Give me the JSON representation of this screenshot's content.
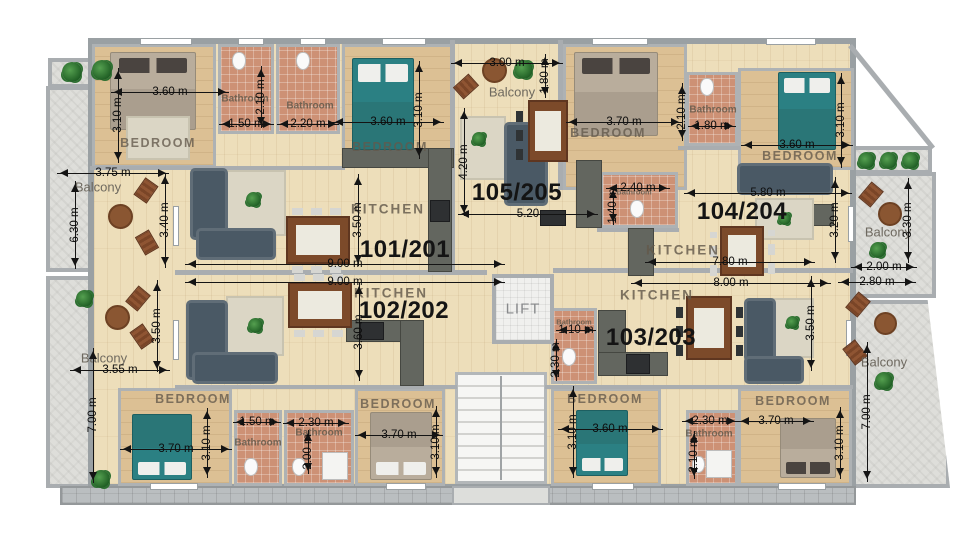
{
  "title": "Apartment building floor plan",
  "colors": {
    "wood_floor": "#eddeba",
    "bedroom_floor": "#dcc094",
    "bathroom_tile": "#cd9175",
    "balcony_stone": "#dededa",
    "wall": "#a9adb0",
    "bed_teal": "#2b8083",
    "sofa": "#4a5965",
    "table_wood": "#7c4a2a",
    "dimension_text": "#0d0d0d"
  },
  "units": [
    {
      "id": "101/201",
      "x": 405,
      "y": 250
    },
    {
      "id": "102/202",
      "x": 404,
      "y": 311
    },
    {
      "id": "105/205",
      "x": 517,
      "y": 193
    },
    {
      "id": "104/204",
      "x": 742,
      "y": 212
    },
    {
      "id": "103/203",
      "x": 651,
      "y": 338
    }
  ],
  "room_labels": [
    {
      "t": "BEDROOM",
      "cls": "bed",
      "x": 158,
      "y": 143
    },
    {
      "t": "BEDROOM",
      "cls": "bed",
      "x": 390,
      "y": 147
    },
    {
      "t": "BEDROOM",
      "cls": "bed",
      "x": 608,
      "y": 133
    },
    {
      "t": "BEDROOM",
      "cls": "bed",
      "x": 800,
      "y": 156
    },
    {
      "t": "BEDROOM",
      "cls": "bed",
      "x": 193,
      "y": 399
    },
    {
      "t": "BEDROOM",
      "cls": "bed",
      "x": 398,
      "y": 404
    },
    {
      "t": "BEDROOM",
      "cls": "bed",
      "x": 605,
      "y": 399
    },
    {
      "t": "BEDROOM",
      "cls": "bed",
      "x": 793,
      "y": 401
    },
    {
      "t": "Bathroom",
      "cls": "bath",
      "x": 245,
      "y": 99
    },
    {
      "t": "Bathroom",
      "cls": "bath",
      "x": 310,
      "y": 106
    },
    {
      "t": "Bathroom",
      "cls": "bath",
      "x": 713,
      "y": 110
    },
    {
      "t": "Bathroom",
      "cls": "bath xs",
      "x": 634,
      "y": 192
    },
    {
      "t": "Bathroom",
      "cls": "bath xs",
      "x": 574,
      "y": 322
    },
    {
      "t": "Bathroom",
      "cls": "bath",
      "x": 258,
      "y": 443
    },
    {
      "t": "Bathroom",
      "cls": "bath",
      "x": 319,
      "y": 433
    },
    {
      "t": "Bathroom",
      "cls": "bath",
      "x": 709,
      "y": 434
    },
    {
      "t": "KITCHEN",
      "cls": "kitchen",
      "x": 388,
      "y": 209
    },
    {
      "t": "KITCHEN",
      "cls": "kitchen",
      "x": 391,
      "y": 293
    },
    {
      "t": "KITCHEN",
      "cls": "kitchen",
      "x": 683,
      "y": 250
    },
    {
      "t": "KITCHEN",
      "cls": "kitchen",
      "x": 657,
      "y": 295
    },
    {
      "t": "Balcony",
      "cls": "balcony",
      "x": 98,
      "y": 187
    },
    {
      "t": "Balcony",
      "cls": "balcony",
      "x": 104,
      "y": 358
    },
    {
      "t": "Balcony",
      "cls": "balcony",
      "x": 512,
      "y": 92
    },
    {
      "t": "Balcony",
      "cls": "balcony",
      "x": 888,
      "y": 232
    },
    {
      "t": "Balcony",
      "cls": "balcony",
      "x": 884,
      "y": 362
    },
    {
      "t": "LIFT",
      "cls": "lift",
      "x": 523,
      "y": 309
    }
  ],
  "dims": [
    {
      "t": "3.60 m",
      "o": "h",
      "cx": 170,
      "cy": 92,
      "len": 118
    },
    {
      "t": "3.10 m",
      "o": "v",
      "cx": 118,
      "cy": 115,
      "len": 95
    },
    {
      "t": "1.50 m",
      "o": "h",
      "cx": 246,
      "cy": 124,
      "len": 55
    },
    {
      "t": "2.20 m",
      "o": "h",
      "cx": 308,
      "cy": 124,
      "len": 62
    },
    {
      "t": "2.10 m",
      "o": "v",
      "cx": 261,
      "cy": 97,
      "len": 62
    },
    {
      "t": "3.75 m",
      "o": "h",
      "cx": 113,
      "cy": 173,
      "len": 112
    },
    {
      "t": "6.30 m",
      "o": "v",
      "cx": 75,
      "cy": 225,
      "len": 88
    },
    {
      "t": "3.40 m",
      "o": "v",
      "cx": 165,
      "cy": 220,
      "len": 95
    },
    {
      "t": "9.00 m",
      "o": "h",
      "cx": 345,
      "cy": 264,
      "len": 320
    },
    {
      "t": "3.50 m",
      "o": "v",
      "cx": 358,
      "cy": 220,
      "len": 92
    },
    {
      "t": "3.00 m",
      "o": "h",
      "cx": 507,
      "cy": 63,
      "len": 112
    },
    {
      "t": "1.80 m",
      "o": "v",
      "cx": 545,
      "cy": 76,
      "len": 44
    },
    {
      "t": "3.60 m",
      "o": "h",
      "cx": 388,
      "cy": 122,
      "len": 112
    },
    {
      "t": "3.10 m",
      "o": "v",
      "cx": 419,
      "cy": 110,
      "len": 98
    },
    {
      "t": "4.20 m",
      "o": "v",
      "cx": 464,
      "cy": 162,
      "len": 108
    },
    {
      "t": "5.20",
      "o": "h",
      "cx": 528,
      "cy": 214,
      "len": 140
    },
    {
      "t": "2.40 m",
      "o": "h",
      "cx": 638,
      "cy": 188,
      "len": 64
    },
    {
      "t": "1.40 m",
      "o": "v",
      "cx": 613,
      "cy": 206,
      "len": 38
    },
    {
      "t": "3.70 m",
      "o": "h",
      "cx": 624,
      "cy": 122,
      "len": 116
    },
    {
      "t": "2.10 m",
      "o": "v",
      "cx": 682,
      "cy": 112,
      "len": 58
    },
    {
      "t": "1.80 m",
      "o": "h",
      "cx": 712,
      "cy": 126,
      "len": 48
    },
    {
      "t": "3.60 m",
      "o": "h",
      "cx": 797,
      "cy": 145,
      "len": 112
    },
    {
      "t": "3.10 m",
      "o": "v",
      "cx": 841,
      "cy": 120,
      "len": 95
    },
    {
      "t": "5.80 m",
      "o": "h",
      "cx": 768,
      "cy": 193,
      "len": 168
    },
    {
      "t": "3.20 m",
      "o": "v",
      "cx": 835,
      "cy": 220,
      "len": 86
    },
    {
      "t": "7.80 m",
      "o": "h",
      "cx": 730,
      "cy": 262,
      "len": 170
    },
    {
      "t": "3.30 m",
      "o": "v",
      "cx": 908,
      "cy": 220,
      "len": 85
    },
    {
      "t": "2.00 m",
      "o": "h",
      "cx": 884,
      "cy": 267,
      "len": 66
    },
    {
      "t": "9.00 m",
      "o": "h",
      "cx": 345,
      "cy": 282,
      "len": 320
    },
    {
      "t": "3.60 m",
      "o": "v",
      "cx": 359,
      "cy": 332,
      "len": 98
    },
    {
      "t": "3.50 m",
      "o": "v",
      "cx": 157,
      "cy": 326,
      "len": 92
    },
    {
      "t": "3.55 m",
      "o": "h",
      "cx": 120,
      "cy": 370,
      "len": 100
    },
    {
      "t": "7.00 m",
      "o": "v",
      "cx": 93,
      "cy": 415,
      "len": 135
    },
    {
      "t": "3.70 m",
      "o": "h",
      "cx": 176,
      "cy": 449,
      "len": 112
    },
    {
      "t": "3.10 m",
      "o": "v",
      "cx": 207,
      "cy": 443,
      "len": 70
    },
    {
      "t": "1.50 m",
      "o": "h",
      "cx": 257,
      "cy": 422,
      "len": 48
    },
    {
      "t": "2.30 m",
      "o": "h",
      "cx": 316,
      "cy": 423,
      "len": 66
    },
    {
      "t": "2.00 m",
      "o": "v",
      "cx": 308,
      "cy": 452,
      "len": 44
    },
    {
      "t": "3.70 m",
      "o": "h",
      "cx": 399,
      "cy": 435,
      "len": 88
    },
    {
      "t": "3.10 m",
      "o": "v",
      "cx": 436,
      "cy": 442,
      "len": 72
    },
    {
      "t": "8.00 m",
      "o": "h",
      "cx": 731,
      "cy": 283,
      "len": 200
    },
    {
      "t": "1.10 m",
      "o": "h",
      "cx": 576,
      "cy": 330,
      "len": 40
    },
    {
      "t": "2.30 m",
      "o": "v",
      "cx": 556,
      "cy": 360,
      "len": 42
    },
    {
      "t": "3.50 m",
      "o": "v",
      "cx": 811,
      "cy": 323,
      "len": 95
    },
    {
      "t": "2.80 m",
      "o": "h",
      "cx": 877,
      "cy": 282,
      "len": 78
    },
    {
      "t": "7.00 m",
      "o": "v",
      "cx": 867,
      "cy": 412,
      "len": 140
    },
    {
      "t": "3.60 m",
      "o": "h",
      "cx": 610,
      "cy": 429,
      "len": 105
    },
    {
      "t": "3.10 m",
      "o": "v",
      "cx": 573,
      "cy": 432,
      "len": 92
    },
    {
      "t": "2.30 m",
      "o": "h",
      "cx": 710,
      "cy": 421,
      "len": 56
    },
    {
      "t": "2.10 m",
      "o": "v",
      "cx": 694,
      "cy": 455,
      "len": 48
    },
    {
      "t": "3.70 m",
      "o": "h",
      "cx": 776,
      "cy": 421,
      "len": 76
    },
    {
      "t": "3.10 m",
      "o": "v",
      "cx": 840,
      "cy": 443,
      "len": 72
    }
  ]
}
